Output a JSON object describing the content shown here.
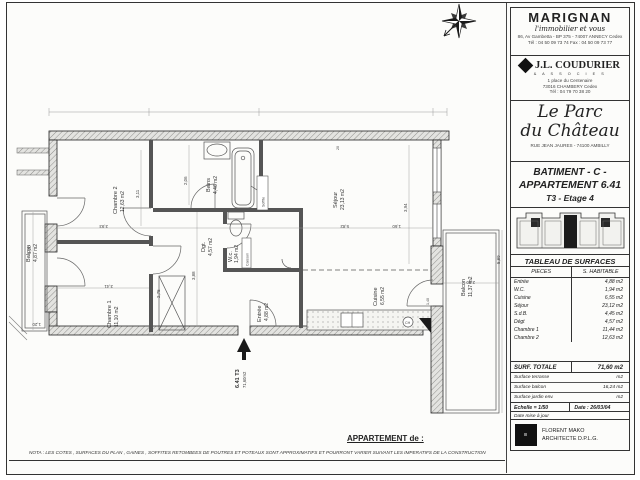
{
  "agency": {
    "name": "MARIGNAN",
    "tagline": "l'immobilier et vous",
    "address": "86, Av Gambetta - BP 375 - 74007 ANNECY Cedex",
    "phone": "Tél : 04 50 09 73 74  Fax : 04 50 09 73 77"
  },
  "firm": {
    "name": "J.L. COUDURIER",
    "subtitle": "& A S S O C I E S",
    "address1": "1 place du Centenaire",
    "address2": "73016 CHAMBERY Cedex",
    "phone": "Tél : 04 79 70 38 20"
  },
  "project": {
    "name_line1": "Le Parc",
    "name_line2": "du Château",
    "address": "RUE JEAN JAURES - 74100 AMBILLY"
  },
  "unit": {
    "building": "BATIMENT - C -",
    "apartment": "APPARTEMENT 6.41",
    "type_floor": "T3   -   Etage 4"
  },
  "surfaces": {
    "title": "TABLEAU DE SURFACES",
    "col_piece": "PIECES",
    "col_surface": "S. HABITABLE",
    "rows": [
      {
        "piece": "Entrée",
        "value": "4,88  m2"
      },
      {
        "piece": "W.C.",
        "value": "1,94  m2"
      },
      {
        "piece": "Cuisine",
        "value": "6,55  m2"
      },
      {
        "piece": "Séjour",
        "value": "23,12  m2"
      },
      {
        "piece": "S.d.B.",
        "value": "4,45  m2"
      },
      {
        "piece": "Dégt",
        "value": "4,57  m2"
      },
      {
        "piece": "Chambre 1",
        "value": "11,44  m2"
      },
      {
        "piece": "Chambre 2",
        "value": "12,63  m2"
      }
    ],
    "total_label": "SURF. TOTALE",
    "total_value": "71,60 m2",
    "extra_rows": [
      {
        "label": "Surface terrasse",
        "value": "m2"
      },
      {
        "label": "Surface balcon",
        "value": "16,24  m2"
      },
      {
        "label": "Surface jardin env.",
        "value": "m2"
      }
    ],
    "scale_label": "Echelle  =   1/50",
    "date_label": "Date :  26/03/04",
    "update_label": "Date mise à jour"
  },
  "architect": {
    "name": "FLORENT MAKO",
    "title": "ARCHITECTE D.P.L.G."
  },
  "footer": {
    "apartment_of": "APPARTEMENT de :",
    "nota": "NOTA : LES COTES , SURFACES DU PLAN , GAINES , SOFFITES RETOMBEES DE POUTRES ET POTEAUX SONT APPROXIMATIFS ET POURRONT VARIER SUIVANT LES IMPERATIFS DE LA CONSTRUCTION"
  },
  "plan": {
    "rooms": {
      "chambre2": {
        "name": "Chambre 2",
        "area": "12,63 m2"
      },
      "bains": {
        "name": "Bains",
        "area": "4,46 m2"
      },
      "sejour": {
        "name": "Séjour",
        "area": "23,13 m2"
      },
      "dgt": {
        "name": "Dgt.",
        "area": "4,57 m2"
      },
      "wc": {
        "name": "W.c.",
        "area": "1,94 m2"
      },
      "entree": {
        "name": "Entrée",
        "area": "4,88 m2"
      },
      "cuisine": {
        "name": "Cuisine",
        "area": "6,55 m2"
      },
      "chambre1": {
        "name": "Chambre 1",
        "area": "11,10 m2"
      },
      "balcon_ouest": {
        "name": "Balcon",
        "area": "4,87 m2"
      },
      "balcon_est": {
        "name": "Balcon",
        "area": "11,37 m2"
      }
    },
    "annotations": {
      "caisson": "Caisson",
      "soffite": "Soffite",
      "ch": "CH",
      "entry_unit": "6.41  T3",
      "entry_area": "71,60m2"
    },
    "dims": [
      "3,93",
      "3,11",
      "2,06",
      "5,82",
      "3,94",
      "2,75",
      "3,41",
      "4,20",
      "1,20",
      "3,88",
      "1,60",
      "5,89",
      "2,80",
      "20",
      "1,40"
    ]
  }
}
